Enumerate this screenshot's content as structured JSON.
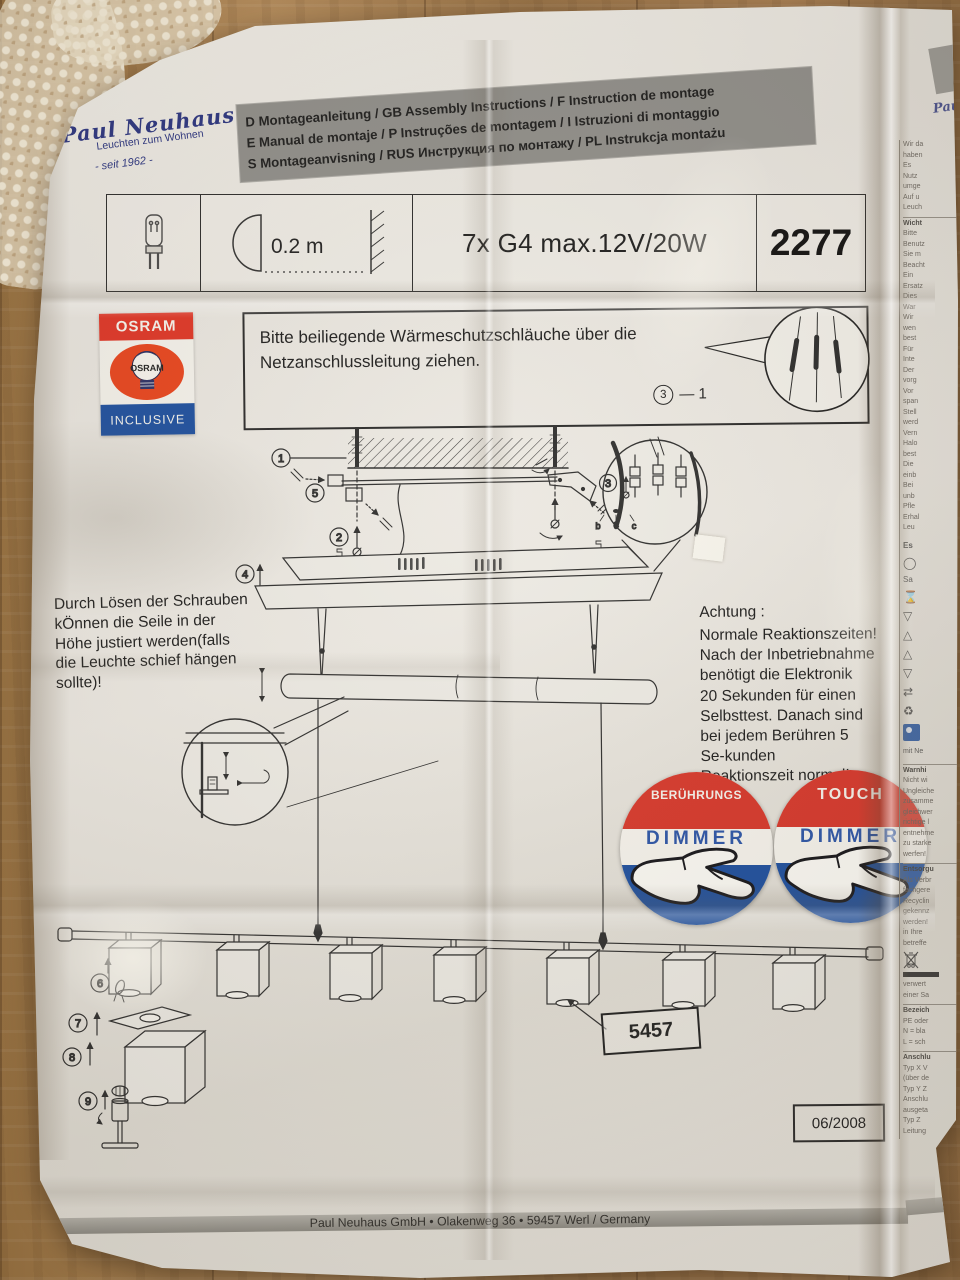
{
  "brand": {
    "name": "Paul Neuhaus",
    "tagline": "Leuchten zum Wohnen",
    "since": "- seit 1962 -",
    "fragment": "Pau"
  },
  "header_bar": {
    "line1": "D Montageanleitung / GB Assembly Instructions / F Instruction de montage",
    "line2": "E Manual de montaje / P Instruções de montagem / I Istruzioni di montaggio",
    "line3": "S Montageanvisning / RUS Инструкция по монтажу / PL Instrukcja montażu"
  },
  "spec": {
    "distance": "0.2 m",
    "lamps": "7x G4 max.12V/20W",
    "model": "2277"
  },
  "osram": {
    "top": "OSRAM",
    "center": "OSRAM",
    "bottom": "INCLUSIVE"
  },
  "sleeve_note": {
    "text": "Bitte beiliegende Wärmeschutzschläuche über die\nNetzanschlussleitung ziehen.",
    "step_suffix": "— 1"
  },
  "steps": {
    "s1": "1",
    "s2": "2",
    "s3": "3",
    "s4": "4",
    "s5": "5",
    "s6": "6",
    "s7": "7",
    "s8": "8",
    "s9": "9"
  },
  "terminals": {
    "a": "a",
    "b": "b",
    "c": "c"
  },
  "height_note": "Durch Lösen der Schrauben\nkÖnnen die Seile in der\nHöhe justiert werden(falls\ndie Leuchte schief hängen\nsollte)!",
  "attention": {
    "title": "Achtung :",
    "body": "Normale Reaktionszeiten!\nNach der Inbetriebnahme\nbenötigt die Elektronik\n20 Sekunden für einen\nSelbsttest. Danach sind\nbei jedem Berühren 5\nSe-kunden\nReaktionszeit normal!"
  },
  "stickers": {
    "left": {
      "top": "BERÜHRUNGS",
      "main": "DIMMER"
    },
    "right": {
      "top": "TOUCH",
      "main": "DIMMER"
    }
  },
  "part_number": "5457",
  "date_code": "06/2008",
  "footer": "Paul Neuhaus GmbH • Olakenweg 36 • 59457 Werl / Germany",
  "side_column": {
    "block1": "Wir da\nhaben\nEs\nNutz\numge\nAuf u\nLeuch",
    "t2": "Wicht",
    "block2": "Bitte\nBenutz\nSie m\nBeacht\nEin\nErsatz\nDies\nWar\nWir\nwen\nbest\nFür\nInte\nDer\nvorg\nVor\nspan\nStell\nwerd\nVern\nHalo\nbest\nDie\neinb\nBei\nunb\nPfle\nErhal\nLeu",
    "es": "Es",
    "sa": "Sa",
    "mit": "mit Ne",
    "t3": "Warnhi",
    "block3": "Nicht wi\nUngleiche\nzusamme\ngleichwer\nrichtige l\nentnehme\nzu starke\nwerfen!",
    "t3b": "Entsorgu",
    "block3b": "Als Verbr\nfachgere\nRecyclin\ngekennz\nwerden!\nin Ihre\nbetreffe",
    "block4": "verwert\neiner Sa",
    "t5": "Bezeich",
    "block5": "PE oder\nN = bla\nL = sch",
    "t6": "Anschlu",
    "block6": "Typ X V\n(über de\nTyp Y Z\nAnschlu\nausgeta\nTyp Z\nLeitung"
  },
  "icons": {
    "circle_glyph": "◯",
    "hourglass": "⌛",
    "triangle_down": "▽",
    "triangle_up": "△",
    "arrows": "⇄",
    "recycle": "♻"
  },
  "colors": {
    "red": "#d7372b",
    "blue": "#1d4f9f",
    "navy": "#2a3480",
    "bar_gray": "#8f8e8a"
  }
}
